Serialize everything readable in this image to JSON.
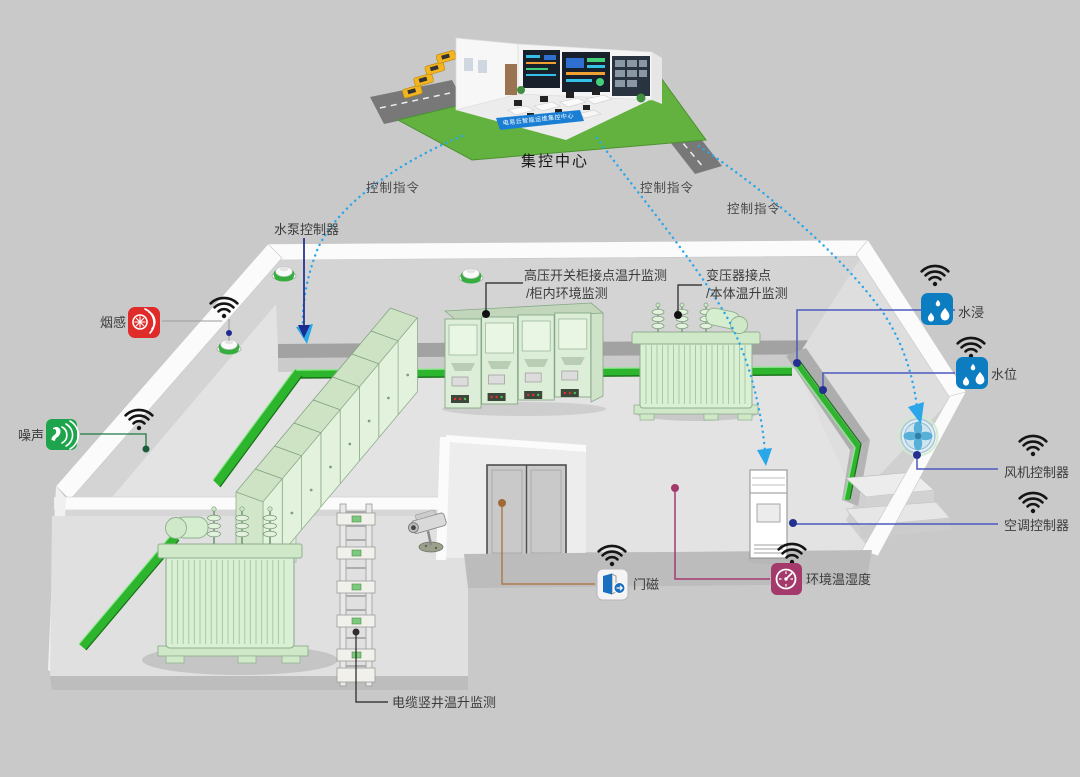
{
  "title": "集控中心",
  "banner": "电易云智能运维集控中心",
  "commands": {
    "c1": "控制指令",
    "c2": "控制指令",
    "c3": "控制指令"
  },
  "labels": {
    "pump_controller": "水泵控制器",
    "smoke": "烟感",
    "noise": "噪声",
    "hv_line1": "高压开关柜接点温升监测",
    "hv_line2": "/柜内环境监测",
    "transformer_line1": "变压器接点",
    "transformer_line2": "/本体温升监测",
    "flood": "水浸",
    "water_level": "水位",
    "fan_controller": "风机控制器",
    "ac_controller": "空调控制器",
    "door_magnet": "门磁",
    "temp_humidity": "环境温湿度",
    "cable_shaft": "电缆竖井温升监测"
  },
  "icons": {
    "wifi": "wifi-icon",
    "smoke": "smoke-sensor-icon",
    "noise": "noise-sensor-icon",
    "flood": "water-drops-icon",
    "water_level": "water-drops-icon",
    "door_magnet": "door-magnet-icon",
    "temp_humidity": "gauge-icon",
    "fan": "fan-icon",
    "detector": "smoke-detector",
    "camera": "cctv-camera"
  },
  "colors": {
    "background": "#c9c9c9",
    "command_blue": "#2aa7e8",
    "indigo_line": "#4c59bd",
    "navy": "#1d2a8e",
    "magenta_line": "#a43a6c",
    "brown_line": "#ad7b4b",
    "smoke_red": "#e02b2b",
    "noise_green": "#1ea44c",
    "water_blue": "#0d7dc1",
    "tray_green": "#2db52d",
    "cabinet_green": "#e3f2dc"
  }
}
